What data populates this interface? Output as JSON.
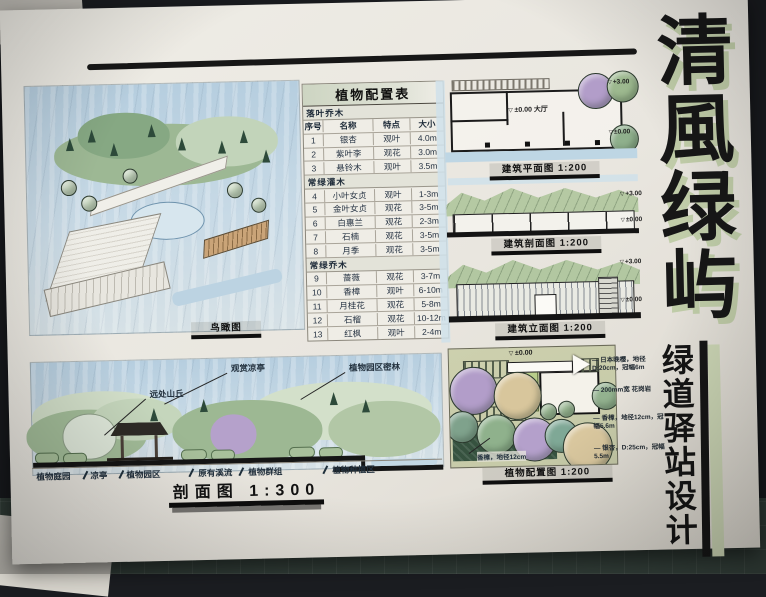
{
  "title_block": {
    "main": "清風绿屿",
    "sub": "绿道驿站设计"
  },
  "birdseye": {
    "label": "鸟瞰图"
  },
  "plant_table": {
    "title": "植物配置表",
    "col_headers": [
      "序号",
      "名称",
      "特点",
      "大小"
    ],
    "sections": [
      {
        "name": "落叶乔木",
        "rows": [
          {
            "no": "1",
            "name": "银杏",
            "trait": "观叶",
            "size": "4.0m"
          },
          {
            "no": "2",
            "name": "紫叶李",
            "trait": "观花",
            "size": "3.0m"
          },
          {
            "no": "3",
            "name": "悬铃木",
            "trait": "观叶",
            "size": "3.5m"
          }
        ]
      },
      {
        "name": "常绿灌木",
        "rows": [
          {
            "no": "4",
            "name": "小叶女贞",
            "trait": "观叶",
            "size": "1-3m"
          },
          {
            "no": "5",
            "name": "金叶女贞",
            "trait": "观花",
            "size": "3-5m"
          },
          {
            "no": "6",
            "name": "白惠兰",
            "trait": "观花",
            "size": "2-3m"
          },
          {
            "no": "7",
            "name": "石楠",
            "trait": "观花",
            "size": "3-5m"
          },
          {
            "no": "8",
            "name": "月季",
            "trait": "观花",
            "size": "3-5m"
          }
        ]
      },
      {
        "name": "常绿乔木",
        "rows": [
          {
            "no": "9",
            "name": "蔷薇",
            "trait": "观花",
            "size": "3-7m"
          },
          {
            "no": "10",
            "name": "香樟",
            "trait": "观叶",
            "size": "6-10m"
          },
          {
            "no": "11",
            "name": "月桂花",
            "trait": "观花",
            "size": "5-8m"
          },
          {
            "no": "12",
            "name": "石榴",
            "trait": "观花",
            "size": "10-12m"
          },
          {
            "no": "13",
            "name": "红枫",
            "trait": "观叶",
            "size": "2-4m"
          }
        ]
      }
    ]
  },
  "right_panels": {
    "plan": {
      "label": "建筑平面图 1:200",
      "annotation": "±0.00 大厅",
      "marks": [
        "+3.00",
        "±0.00"
      ]
    },
    "section": {
      "label": "建筑剖面图 1:200",
      "marks": [
        "+3.00",
        "±0.00"
      ]
    },
    "elevation": {
      "label": "建筑立面图 1:200",
      "marks": [
        "+3.00",
        "±0.00"
      ]
    }
  },
  "site_section": {
    "label": "剖面图 1:300",
    "callouts": [
      "观赏凉亭",
      "远处山丘",
      "植物园区密林"
    ],
    "zones": [
      "植物庭园",
      "凉亭",
      "植物园区",
      "原有溪流",
      "植物群组",
      "植物种植区"
    ]
  },
  "planting_plan": {
    "label": "植物配置图 1:200",
    "elevation_mark": "±0.00",
    "notes": [
      "日本晚樱，地径D:20cm，冠幅6m",
      "200mm宽 花岗岩",
      "香樟，地径12cm，冠幅5.6m",
      "银杏，D:25cm，冠幅5.5m"
    ],
    "callout": "香樟，地径12cm"
  }
}
